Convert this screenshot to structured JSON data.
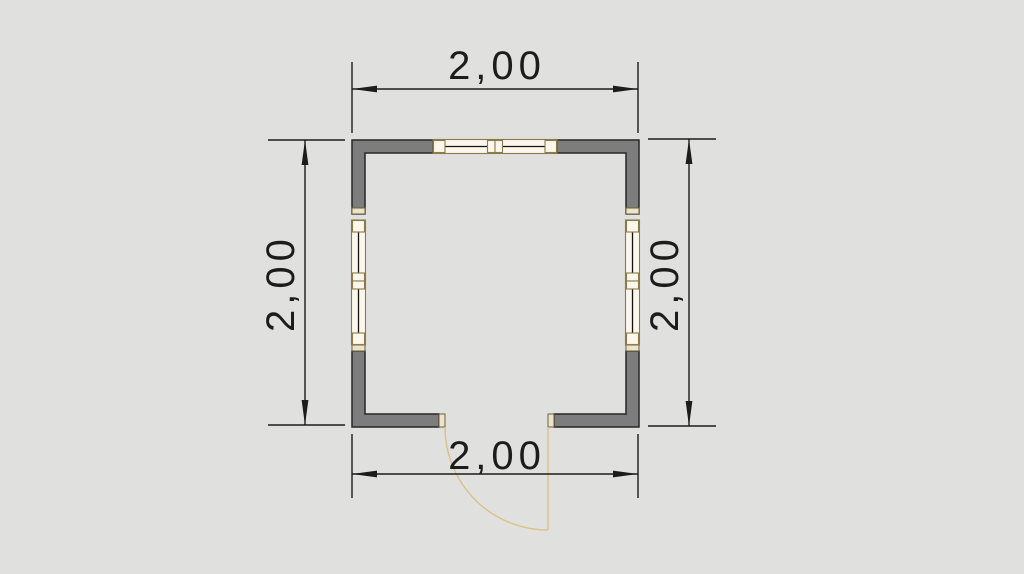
{
  "scene": {
    "type": "cad-floor-plan",
    "background_color": "#e0e0df",
    "wall_fill": "#7d7d7d",
    "wall_outline": "#262626",
    "window_frame_color": "#8c7b4a",
    "window_fill": "#fbf7ec",
    "wall_cap_fill": "#ebe3cc",
    "wall_cap_outline": "#6b5f3a",
    "door_color": "#d9c285",
    "dimension_color": "#1c1c1c",
    "dimensions": {
      "top": {
        "label": "2,00"
      },
      "bottom": {
        "label": "2,00"
      },
      "left": {
        "label": "2,00"
      },
      "right": {
        "label": "2,00"
      }
    }
  }
}
